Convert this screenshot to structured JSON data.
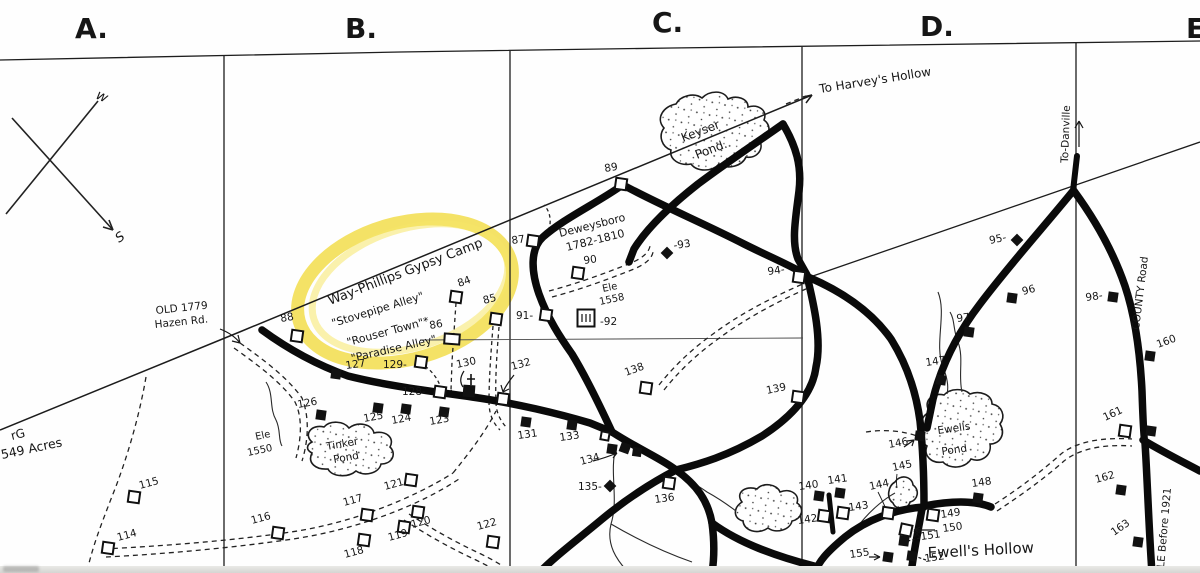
{
  "map_title": "Hand-drawn township survey map",
  "highlight": {
    "color": "#f2dd4b",
    "circled_text": "Way-Phillips Gypsy Camp"
  },
  "grid_letters": [
    {
      "t": "A.",
      "x": 75,
      "y": 38
    },
    {
      "t": "B.",
      "x": 345,
      "y": 38
    },
    {
      "t": "C.",
      "x": 652,
      "y": 32
    },
    {
      "t": "D.",
      "x": 920,
      "y": 36
    },
    {
      "t": "E",
      "x": 1186,
      "y": 38
    }
  ],
  "annotations": [
    {
      "text": "Way-Phillips Gypsy Camp",
      "x": 330,
      "y": 305,
      "r": -21,
      "s": 13
    },
    {
      "text": "\"Stovepipe Alley\"",
      "x": 333,
      "y": 327,
      "r": -17,
      "s": 11
    },
    {
      "text": "\"Rouser Town\"*",
      "x": 348,
      "y": 346,
      "r": -15,
      "s": 11
    },
    {
      "text": "\"Paradise Alley\"",
      "x": 352,
      "y": 362,
      "r": -13,
      "s": 11
    },
    {
      "text": "To Harvey's Hollow",
      "x": 820,
      "y": 93,
      "r": -9,
      "s": 12
    },
    {
      "text": "Deweysboro",
      "x": 560,
      "y": 237,
      "r": -14,
      "s": 11
    },
    {
      "text": "1782-1810",
      "x": 567,
      "y": 251,
      "r": -14,
      "s": 11
    },
    {
      "text": "Ele",
      "x": 603,
      "y": 292,
      "r": -12,
      "s": 10
    },
    {
      "text": "1558",
      "x": 600,
      "y": 305,
      "r": -12,
      "s": 10
    },
    {
      "text": "Ele",
      "x": 256,
      "y": 440,
      "r": -12,
      "s": 10
    },
    {
      "text": "1550",
      "x": 248,
      "y": 456,
      "r": -12,
      "s": 10
    },
    {
      "text": "Keyser",
      "x": 683,
      "y": 142,
      "r": -21,
      "s": 12
    },
    {
      "text": "Pond.",
      "x": 697,
      "y": 159,
      "r": -21,
      "s": 12
    },
    {
      "text": "Tinker",
      "x": 327,
      "y": 450,
      "r": -10,
      "s": 10.5
    },
    {
      "text": "Pond",
      "x": 334,
      "y": 463,
      "r": -10,
      "s": 10.5
    },
    {
      "text": "Ewells",
      "x": 938,
      "y": 434,
      "r": -8,
      "s": 10.5
    },
    {
      "text": "Pond",
      "x": 942,
      "y": 455,
      "r": -8,
      "s": 10.5
    },
    {
      "text": "Ewell's Hollow",
      "x": 928,
      "y": 558,
      "r": -3,
      "s": 15
    },
    {
      "text": "rG",
      "x": 12,
      "y": 440,
      "r": -14,
      "s": 12
    },
    {
      "text": "549 Acres",
      "x": 2,
      "y": 459,
      "r": -12,
      "s": 12.5
    },
    {
      "text": "OLD 1779",
      "x": 156,
      "y": 314,
      "r": -6,
      "s": 10.5
    },
    {
      "text": "Hazen Rd.",
      "x": 155,
      "y": 328,
      "r": -6,
      "s": 10.5
    },
    {
      "text": "COUNTY Road",
      "x": 1139,
      "y": 330,
      "r": -83,
      "s": 10.5
    },
    {
      "text": "To-Danville",
      "x": 1068,
      "y": 163,
      "r": -88,
      "s": 10.5
    },
    {
      "text": "LE Before 1921",
      "x": 1164,
      "y": 568,
      "r": -85,
      "s": 10.5
    },
    {
      "text": "w",
      "x": 95,
      "y": 98,
      "r": 25,
      "s": 14,
      "i": 1
    },
    {
      "text": "S",
      "x": 119,
      "y": 243,
      "r": -35,
      "s": 13,
      "i": 1
    }
  ],
  "markers": [
    {
      "label": "88",
      "type": "o",
      "x": 297,
      "y": 336,
      "lx": 281,
      "ly": 322,
      "lr": -10
    },
    {
      "label": "89",
      "type": "o",
      "x": 621,
      "y": 184,
      "lx": 605,
      "ly": 172,
      "lr": -10
    },
    {
      "label": "84",
      "type": "o",
      "x": 456,
      "y": 297,
      "lx": 459,
      "ly": 287,
      "lr": -20
    },
    {
      "label": "85",
      "type": "o",
      "x": 496,
      "y": 319,
      "lx": 484,
      "ly": 304,
      "lr": -15
    },
    {
      "label": "86",
      "type": "ow",
      "x": 452,
      "y": 339,
      "lx": 430,
      "ly": 329,
      "lr": -10
    },
    {
      "label": "87",
      "type": "o",
      "x": 533,
      "y": 241,
      "lx": 512,
      "ly": 244,
      "lr": -8
    },
    {
      "label": "90",
      "type": "o",
      "x": 578,
      "y": 273,
      "lx": 584,
      "ly": 264,
      "lr": -8
    },
    {
      "label": "91-",
      "type": "o",
      "x": 546,
      "y": 315,
      "lx": 516,
      "ly": 319,
      "lr": 0
    },
    {
      "label": "-92",
      "type": "cem",
      "x": 586,
      "y": 318,
      "lx": 600,
      "ly": 325,
      "lr": 0
    },
    {
      "label": "-93",
      "type": "d",
      "x": 667,
      "y": 253,
      "lx": 674,
      "ly": 249,
      "lr": -8
    },
    {
      "label": "94-",
      "type": "o",
      "x": 799,
      "y": 277,
      "lx": 768,
      "ly": 275,
      "lr": -8
    },
    {
      "label": "95-",
      "type": "d",
      "x": 1017,
      "y": 240,
      "lx": 990,
      "ly": 244,
      "lr": -12
    },
    {
      "label": "96",
      "type": "f",
      "x": 1012,
      "y": 298,
      "lx": 1023,
      "ly": 295,
      "lr": -15
    },
    {
      "label": "97",
      "type": "f",
      "x": 969,
      "y": 332,
      "lx": 957,
      "ly": 322,
      "lr": -8
    },
    {
      "label": "98-",
      "type": "f",
      "x": 1113,
      "y": 297,
      "lx": 1086,
      "ly": 301,
      "lr": -8
    },
    {
      "label": "114",
      "type": "o",
      "x": 108,
      "y": 548,
      "lx": 118,
      "ly": 541,
      "lr": -15
    },
    {
      "label": "115",
      "type": "o",
      "x": 134,
      "y": 497,
      "lx": 140,
      "ly": 489,
      "lr": -15
    },
    {
      "label": "116",
      "type": "o",
      "x": 278,
      "y": 533,
      "lx": 252,
      "ly": 524,
      "lr": -15
    },
    {
      "label": "117",
      "type": "o",
      "x": 367,
      "y": 515,
      "lx": 344,
      "ly": 506,
      "lr": -15
    },
    {
      "label": "118",
      "type": "o",
      "x": 364,
      "y": 540,
      "lx": 345,
      "ly": 558,
      "lr": -15
    },
    {
      "label": "119",
      "type": "o",
      "x": 404,
      "y": 527,
      "lx": 389,
      "ly": 541,
      "lr": -15
    },
    {
      "label": "120",
      "type": "o",
      "x": 418,
      "y": 512,
      "lx": 412,
      "ly": 528,
      "lr": -15
    },
    {
      "label": "121",
      "type": "o",
      "x": 411,
      "y": 480,
      "lx": 385,
      "ly": 490,
      "lr": -15
    },
    {
      "label": "122",
      "type": "o",
      "x": 493,
      "y": 542,
      "lx": 478,
      "ly": 530,
      "lr": -15
    },
    {
      "label": "123",
      "type": "f",
      "x": 444,
      "y": 412,
      "lx": 430,
      "ly": 425,
      "lr": -10
    },
    {
      "label": "124",
      "type": "f",
      "x": 406,
      "y": 409,
      "lx": 392,
      "ly": 424,
      "lr": -10
    },
    {
      "label": "125",
      "type": "f",
      "x": 378,
      "y": 408,
      "lx": 364,
      "ly": 422,
      "lr": -10
    },
    {
      "label": "126",
      "type": "f",
      "x": 321,
      "y": 415,
      "lx": 298,
      "ly": 408,
      "lr": -10
    },
    {
      "label": "127",
      "type": "f",
      "x": 336,
      "y": 374,
      "lx": 346,
      "ly": 369,
      "lr": -8
    },
    {
      "label": "129-",
      "type": "o",
      "x": 421,
      "y": 362,
      "lx": 383,
      "ly": 368,
      "lr": 0
    },
    {
      "label": "128-",
      "type": "o",
      "x": 440,
      "y": 392,
      "lx": 402,
      "ly": 395,
      "lr": 0
    },
    {
      "label": "130",
      "type": "ch",
      "x": 469,
      "y": 391,
      "lx": 457,
      "ly": 368,
      "lr": -12
    },
    {
      "label": "131",
      "type": "f",
      "x": 526,
      "y": 422,
      "lx": 518,
      "ly": 439,
      "lr": -8
    },
    {
      "label": "132",
      "type": "o",
      "x": 503,
      "y": 399,
      "lx": 512,
      "ly": 370,
      "lr": -15
    },
    {
      "label": "133",
      "type": "f",
      "x": 572,
      "y": 425,
      "lx": 560,
      "ly": 441,
      "lr": -8
    },
    {
      "label": "134",
      "type": "f3",
      "x": 612,
      "y": 449,
      "lx": 581,
      "ly": 465,
      "lr": -15
    },
    {
      "label": "135-",
      "type": "d",
      "x": 610,
      "y": 486,
      "lx": 578,
      "ly": 490,
      "lr": 0
    },
    {
      "label": "136",
      "type": "o",
      "x": 669,
      "y": 483,
      "lx": 655,
      "ly": 503,
      "lr": -8
    },
    {
      "label": "138",
      "type": "o",
      "x": 646,
      "y": 388,
      "lx": 626,
      "ly": 376,
      "lr": -20
    },
    {
      "label": "139",
      "type": "o",
      "x": 798,
      "y": 397,
      "lx": 767,
      "ly": 394,
      "lr": -12
    },
    {
      "label": "140",
      "type": "f",
      "x": 819,
      "y": 496,
      "lx": 799,
      "ly": 490,
      "lr": -8
    },
    {
      "label": "141",
      "type": "f",
      "x": 840,
      "y": 493,
      "lx": 828,
      "ly": 484,
      "lr": -8
    },
    {
      "label": "142",
      "type": "o",
      "x": 824,
      "y": 516,
      "lx": 798,
      "ly": 524,
      "lr": -8
    },
    {
      "label": "143",
      "type": "o",
      "x": 843,
      "y": 513,
      "lx": 849,
      "ly": 511,
      "lr": -8
    },
    {
      "label": "144",
      "type": "o",
      "x": 888,
      "y": 513,
      "lx": 870,
      "ly": 490,
      "lr": -12
    },
    {
      "label": "145",
      "type": "none",
      "x": 0,
      "y": 0,
      "lx": 893,
      "ly": 471,
      "lr": -12
    },
    {
      "label": "146",
      "type": "f",
      "x": 920,
      "y": 436,
      "lx": 889,
      "ly": 448,
      "lr": -10
    },
    {
      "label": "147",
      "type": "f",
      "x": 941,
      "y": 380,
      "lx": 926,
      "ly": 366,
      "lr": -8
    },
    {
      "label": "148",
      "type": "f",
      "x": 978,
      "y": 498,
      "lx": 972,
      "ly": 487,
      "lr": -8
    },
    {
      "label": "149",
      "type": "o",
      "x": 933,
      "y": 515,
      "lx": 941,
      "ly": 518,
      "lr": -8
    },
    {
      "label": "150",
      "type": "ox",
      "x": 906,
      "y": 530,
      "lx": 943,
      "ly": 532,
      "lr": -8
    },
    {
      "label": "151",
      "type": "f",
      "x": 904,
      "y": 541,
      "lx": 921,
      "ly": 540,
      "lr": -8
    },
    {
      "label": "152",
      "type": "f",
      "x": 912,
      "y": 556,
      "lx": 925,
      "ly": 562,
      "lr": -8
    },
    {
      "label": "155",
      "type": "f",
      "x": 888,
      "y": 557,
      "lx": 850,
      "ly": 558,
      "lr": -8
    },
    {
      "label": "160",
      "type": "f",
      "x": 1150,
      "y": 356,
      "lx": 1158,
      "ly": 348,
      "lr": -20
    },
    {
      "label": "161",
      "type": "o",
      "x": 1125,
      "y": 431,
      "lx": 1105,
      "ly": 421,
      "lr": -25
    },
    {
      "label": "",
      "type": "f",
      "x": 1151,
      "y": 431,
      "lx": 0,
      "ly": 0,
      "lr": 0
    },
    {
      "label": "162",
      "type": "f",
      "x": 1121,
      "y": 490,
      "lx": 1096,
      "ly": 483,
      "lr": -15
    },
    {
      "label": "163",
      "type": "f",
      "x": 1138,
      "y": 542,
      "lx": 1114,
      "ly": 536,
      "lr": -35
    }
  ]
}
